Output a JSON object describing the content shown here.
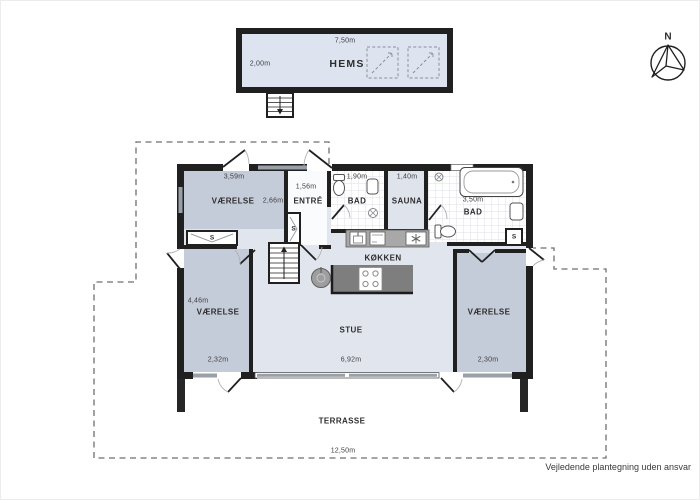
{
  "compass_label": "N",
  "disclaimer": "Vejledende plantegning uden ansvar",
  "closet_label": "S",
  "hems": {
    "name": "HEMS",
    "dim_width": "7,50m",
    "dim_depth": "2,00m"
  },
  "rooms": {
    "vaerelse_nw": {
      "name": "VÆRELSE",
      "dim_width": "3,59m",
      "dim_depth": "2,66m"
    },
    "entre": {
      "name": "ENTRÉ",
      "dim_width": "1,56m"
    },
    "bad_small": {
      "name": "BAD",
      "dim_width": "1,90m"
    },
    "sauna": {
      "name": "SAUNA",
      "dim_width": "1,40m"
    },
    "bad_large": {
      "name": "BAD",
      "dim_width": "3,50m"
    },
    "koekken": {
      "name": "KØKKEN"
    },
    "vaerelse_w": {
      "name": "VÆRELSE",
      "dim_depth": "4,46m",
      "dim_width": "2,32m"
    },
    "stue": {
      "name": "STUE",
      "dim_width": "6,92m"
    },
    "vaerelse_e": {
      "name": "VÆRELSE",
      "dim_width": "2,30m"
    },
    "terrasse": {
      "name": "TERRASSE",
      "dim_width": "12,50m"
    }
  },
  "colors": {
    "wall": "#202020",
    "bedroom_fill": "#c5ccd9",
    "living_fill": "#e1e6ee",
    "hems_fill": "#dde4ef",
    "counter": "#a8a8a8",
    "island": "#7e7e7e",
    "window": "#9aa0a8"
  }
}
